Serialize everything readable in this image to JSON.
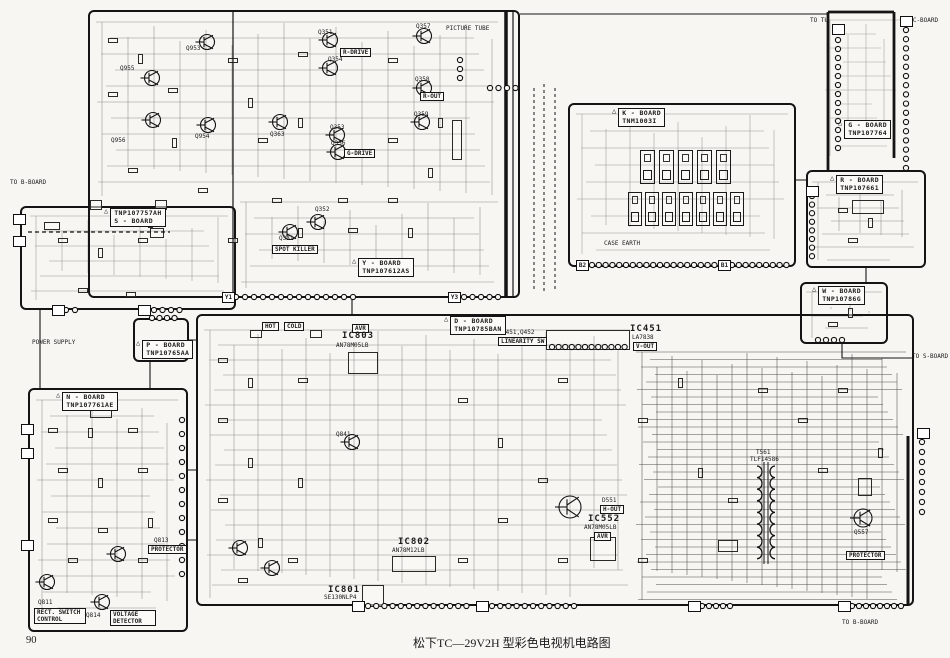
{
  "meta": {
    "caption": "松下TC—29V2H 型彩色电视机电路图",
    "page_number": "90",
    "ink_color": "#141414",
    "paper_color": "#f7f6f2"
  },
  "boards": [
    {
      "name": "Y - BOARD",
      "part": "TNP107612AS",
      "x": 88,
      "y": 10,
      "w": 432,
      "h": 288,
      "lx": 352,
      "ly": 258
    },
    {
      "name": "S - BOARD",
      "part": "TNP107757AH",
      "partFirst": true,
      "x": 20,
      "y": 206,
      "w": 216,
      "h": 104,
      "lx": 104,
      "ly": 208
    },
    {
      "name": "K - BOARD",
      "part": "TNM1003I",
      "x": 568,
      "y": 103,
      "w": 228,
      "h": 164,
      "lx": 612,
      "ly": 108
    },
    {
      "name": "D - BOARD",
      "part": "TNP10785BAN",
      "x": 196,
      "y": 314,
      "w": 718,
      "h": 292,
      "lx": 444,
      "ly": 316
    },
    {
      "name": "N - BOARD",
      "part": "TNP107761AE",
      "x": 28,
      "y": 388,
      "w": 160,
      "h": 244,
      "lx": 56,
      "ly": 392
    },
    {
      "name": "R - BOARD",
      "part": "TNP107661",
      "x": 806,
      "y": 170,
      "w": 120,
      "h": 98,
      "lx": 830,
      "ly": 175
    },
    {
      "name": "W - BOARD",
      "part": "TNP10786G",
      "x": 800,
      "y": 282,
      "w": 88,
      "h": 62,
      "lx": 812,
      "ly": 286
    },
    {
      "name": "P - BOARD",
      "part": "TNP10765AA",
      "x": 133,
      "y": 318,
      "w": 56,
      "h": 44,
      "lx": 136,
      "ly": 340
    },
    {
      "name": "G - BOARD",
      "part": "TNP107764",
      "noborder": true,
      "x": 820,
      "y": 12,
      "w": 126,
      "h": 148,
      "lx": 838,
      "ly": 120
    }
  ],
  "annotations": [
    {
      "t": "Q953",
      "x": 186,
      "y": 46,
      "c": "t"
    },
    {
      "t": "Q955",
      "x": 120,
      "y": 66,
      "c": "t"
    },
    {
      "t": "Q956",
      "x": 111,
      "y": 138,
      "c": "t"
    },
    {
      "t": "Q954",
      "x": 195,
      "y": 134,
      "c": "t"
    },
    {
      "t": "Q363",
      "x": 270,
      "y": 132,
      "c": "t"
    },
    {
      "t": "Q351",
      "x": 318,
      "y": 30,
      "c": "t"
    },
    {
      "t": "Q354",
      "x": 328,
      "y": 57,
      "c": "t"
    },
    {
      "t": "R-DRIVE",
      "x": 340,
      "y": 48,
      "c": "box"
    },
    {
      "t": "Q357",
      "x": 416,
      "y": 24,
      "c": "t"
    },
    {
      "t": "Q358",
      "x": 415,
      "y": 77,
      "c": "t"
    },
    {
      "t": "R-OUT",
      "x": 420,
      "y": 92,
      "c": "box"
    },
    {
      "t": "Q359",
      "x": 414,
      "y": 112,
      "c": "t"
    },
    {
      "t": "Q353",
      "x": 330,
      "y": 125,
      "c": "t"
    },
    {
      "t": "Q356",
      "x": 331,
      "y": 141,
      "c": "t"
    },
    {
      "t": "G-DRIVE",
      "x": 344,
      "y": 149,
      "c": "box"
    },
    {
      "t": "Q352",
      "x": 315,
      "y": 207,
      "c": "t"
    },
    {
      "t": "Q331",
      "x": 279,
      "y": 236,
      "c": "t"
    },
    {
      "t": "SPOT KILLER",
      "x": 272,
      "y": 245,
      "c": "box"
    },
    {
      "t": "PICTURE TUBE",
      "x": 446,
      "y": 26,
      "c": "t"
    },
    {
      "t": "TO B-BOARD",
      "x": 10,
      "y": 180,
      "c": "t"
    },
    {
      "t": "POWER SUPPLY",
      "x": 32,
      "y": 340,
      "c": "t"
    },
    {
      "t": "HOT",
      "x": 262,
      "y": 322,
      "c": "box"
    },
    {
      "t": "COLD",
      "x": 284,
      "y": 322,
      "c": "box"
    },
    {
      "t": "AVR",
      "x": 352,
      "y": 324,
      "c": "box"
    },
    {
      "t": "IC803",
      "x": 342,
      "y": 332,
      "c": "m"
    },
    {
      "t": "AN78M05LB",
      "x": 336,
      "y": 343,
      "c": "t"
    },
    {
      "t": "Q451,Q452",
      "x": 502,
      "y": 330,
      "c": "t"
    },
    {
      "t": "LINEARITY SW",
      "x": 498,
      "y": 337,
      "c": "box"
    },
    {
      "t": "IC451",
      "x": 630,
      "y": 325,
      "c": "m"
    },
    {
      "t": "LA7838",
      "x": 632,
      "y": 335,
      "c": "t"
    },
    {
      "t": "V-OUT",
      "x": 633,
      "y": 342,
      "c": "box"
    },
    {
      "t": "Q841",
      "x": 336,
      "y": 432,
      "c": "t"
    },
    {
      "t": "IC802",
      "x": 398,
      "y": 538,
      "c": "m"
    },
    {
      "t": "AN78M12LB",
      "x": 392,
      "y": 548,
      "c": "t"
    },
    {
      "t": "IC801",
      "x": 328,
      "y": 586,
      "c": "m"
    },
    {
      "t": "SE130NLP4",
      "x": 324,
      "y": 595,
      "c": "t"
    },
    {
      "t": "D551",
      "x": 602,
      "y": 498,
      "c": "t"
    },
    {
      "t": "H-OUT",
      "x": 600,
      "y": 505,
      "c": "box"
    },
    {
      "t": "IC552",
      "x": 588,
      "y": 515,
      "c": "m"
    },
    {
      "t": "AN78M05LB",
      "x": 584,
      "y": 525,
      "c": "t"
    },
    {
      "t": "AVR",
      "x": 594,
      "y": 532,
      "c": "box"
    },
    {
      "t": "T561",
      "x": 756,
      "y": 450,
      "c": "t"
    },
    {
      "t": "TLF14586",
      "x": 750,
      "y": 457,
      "c": "t"
    },
    {
      "t": "Q557",
      "x": 854,
      "y": 530,
      "c": "t"
    },
    {
      "t": "PROTECTOR",
      "x": 846,
      "y": 551,
      "c": "box"
    },
    {
      "t": "CASE EARTH",
      "x": 604,
      "y": 241,
      "c": "t"
    },
    {
      "t": "Q811",
      "x": 38,
      "y": 600,
      "c": "t"
    },
    {
      "t": "RECT. SWITCH CONTROL",
      "x": 34,
      "y": 608,
      "c": "box",
      "w": 46
    },
    {
      "t": "Q814",
      "x": 86,
      "y": 613,
      "c": "t"
    },
    {
      "t": "VOLTAGE DETECTOR",
      "x": 110,
      "y": 610,
      "c": "box",
      "w": 40
    },
    {
      "t": "Q813",
      "x": 154,
      "y": 538,
      "c": "t"
    },
    {
      "t": "PROTECTOR",
      "x": 148,
      "y": 545,
      "c": "box"
    },
    {
      "t": "TO TU",
      "x": 810,
      "y": 18,
      "c": "t"
    },
    {
      "t": "TO C-BOARD",
      "x": 902,
      "y": 18,
      "c": "t"
    },
    {
      "t": "TO S-BOARD",
      "x": 912,
      "y": 354,
      "c": "t"
    },
    {
      "t": "TO B-BOARD",
      "x": 842,
      "y": 620,
      "c": "t"
    }
  ],
  "transistors": [
    {
      "x": 207,
      "y": 42
    },
    {
      "x": 152,
      "y": 78
    },
    {
      "x": 153,
      "y": 120
    },
    {
      "x": 208,
      "y": 125
    },
    {
      "x": 280,
      "y": 122
    },
    {
      "x": 330,
      "y": 40
    },
    {
      "x": 330,
      "y": 68
    },
    {
      "x": 424,
      "y": 36
    },
    {
      "x": 424,
      "y": 88
    },
    {
      "x": 422,
      "y": 122
    },
    {
      "x": 337,
      "y": 135
    },
    {
      "x": 338,
      "y": 152
    },
    {
      "x": 318,
      "y": 222
    },
    {
      "x": 290,
      "y": 232
    },
    {
      "x": 352,
      "y": 442
    },
    {
      "x": 570,
      "y": 507,
      "r": 11
    },
    {
      "x": 863,
      "y": 518,
      "r": 9
    },
    {
      "x": 47,
      "y": 582
    },
    {
      "x": 102,
      "y": 602
    },
    {
      "x": 118,
      "y": 554
    },
    {
      "x": 240,
      "y": 548
    },
    {
      "x": 272,
      "y": 568
    }
  ],
  "parts": [
    {
      "x": 348,
      "y": 352,
      "w": 30,
      "h": 22
    },
    {
      "x": 546,
      "y": 330,
      "w": 84,
      "h": 20
    },
    {
      "x": 590,
      "y": 537,
      "w": 26,
      "h": 24
    },
    {
      "x": 392,
      "y": 556,
      "w": 44,
      "h": 16
    },
    {
      "x": 362,
      "y": 585,
      "w": 22,
      "h": 22
    },
    {
      "x": 108,
      "y": 38,
      "w": 10,
      "h": 5
    },
    {
      "x": 108,
      "y": 92,
      "w": 10,
      "h": 5
    },
    {
      "x": 138,
      "y": 54,
      "w": 5,
      "h": 10
    },
    {
      "x": 168,
      "y": 88,
      "w": 10,
      "h": 5
    },
    {
      "x": 172,
      "y": 138,
      "w": 5,
      "h": 10
    },
    {
      "x": 228,
      "y": 58,
      "w": 10,
      "h": 5
    },
    {
      "x": 248,
      "y": 98,
      "w": 5,
      "h": 10
    },
    {
      "x": 258,
      "y": 138,
      "w": 10,
      "h": 5
    },
    {
      "x": 298,
      "y": 52,
      "w": 10,
      "h": 5
    },
    {
      "x": 298,
      "y": 118,
      "w": 5,
      "h": 10
    },
    {
      "x": 388,
      "y": 58,
      "w": 10,
      "h": 5
    },
    {
      "x": 388,
      "y": 138,
      "w": 10,
      "h": 5
    },
    {
      "x": 438,
      "y": 118,
      "w": 5,
      "h": 10
    },
    {
      "x": 272,
      "y": 198,
      "w": 10,
      "h": 5
    },
    {
      "x": 298,
      "y": 228,
      "w": 5,
      "h": 10
    },
    {
      "x": 338,
      "y": 198,
      "w": 10,
      "h": 5
    },
    {
      "x": 388,
      "y": 198,
      "w": 10,
      "h": 5
    },
    {
      "x": 428,
      "y": 168,
      "w": 5,
      "h": 10
    },
    {
      "x": 128,
      "y": 168,
      "w": 10,
      "h": 5
    },
    {
      "x": 148,
      "y": 218,
      "w": 5,
      "h": 10
    },
    {
      "x": 198,
      "y": 188,
      "w": 10,
      "h": 5
    },
    {
      "x": 228,
      "y": 238,
      "w": 10,
      "h": 5
    },
    {
      "x": 348,
      "y": 228,
      "w": 10,
      "h": 5
    },
    {
      "x": 408,
      "y": 228,
      "w": 5,
      "h": 10
    },
    {
      "x": 452,
      "y": 120,
      "w": 10,
      "h": 40
    },
    {
      "x": 90,
      "y": 200,
      "w": 12,
      "h": 10
    },
    {
      "x": 155,
      "y": 200,
      "w": 12,
      "h": 10
    },
    {
      "x": 58,
      "y": 238,
      "w": 10,
      "h": 5
    },
    {
      "x": 98,
      "y": 248,
      "w": 5,
      "h": 10
    },
    {
      "x": 138,
      "y": 238,
      "w": 10,
      "h": 5
    },
    {
      "x": 78,
      "y": 288,
      "w": 10,
      "h": 5
    },
    {
      "x": 126,
      "y": 292,
      "w": 10,
      "h": 5
    },
    {
      "x": 44,
      "y": 222,
      "w": 16,
      "h": 8
    },
    {
      "x": 150,
      "y": 228,
      "w": 14,
      "h": 10
    },
    {
      "x": 48,
      "y": 428,
      "w": 10,
      "h": 5
    },
    {
      "x": 88,
      "y": 428,
      "w": 5,
      "h": 10
    },
    {
      "x": 128,
      "y": 428,
      "w": 10,
      "h": 5
    },
    {
      "x": 58,
      "y": 468,
      "w": 10,
      "h": 5
    },
    {
      "x": 98,
      "y": 478,
      "w": 5,
      "h": 10
    },
    {
      "x": 138,
      "y": 468,
      "w": 10,
      "h": 5
    },
    {
      "x": 48,
      "y": 518,
      "w": 10,
      "h": 5
    },
    {
      "x": 98,
      "y": 528,
      "w": 10,
      "h": 5
    },
    {
      "x": 148,
      "y": 518,
      "w": 5,
      "h": 10
    },
    {
      "x": 68,
      "y": 558,
      "w": 10,
      "h": 5
    },
    {
      "x": 138,
      "y": 558,
      "w": 10,
      "h": 5
    },
    {
      "x": 90,
      "y": 410,
      "w": 22,
      "h": 8
    },
    {
      "x": 218,
      "y": 358,
      "w": 10,
      "h": 5
    },
    {
      "x": 248,
      "y": 378,
      "w": 5,
      "h": 10
    },
    {
      "x": 218,
      "y": 418,
      "w": 10,
      "h": 5
    },
    {
      "x": 248,
      "y": 458,
      "w": 5,
      "h": 10
    },
    {
      "x": 218,
      "y": 498,
      "w": 10,
      "h": 5
    },
    {
      "x": 258,
      "y": 538,
      "w": 5,
      "h": 10
    },
    {
      "x": 298,
      "y": 378,
      "w": 10,
      "h": 5
    },
    {
      "x": 298,
      "y": 478,
      "w": 5,
      "h": 10
    },
    {
      "x": 458,
      "y": 398,
      "w": 10,
      "h": 5
    },
    {
      "x": 498,
      "y": 438,
      "w": 5,
      "h": 10
    },
    {
      "x": 538,
      "y": 478,
      "w": 10,
      "h": 5
    },
    {
      "x": 458,
      "y": 558,
      "w": 10,
      "h": 5
    },
    {
      "x": 558,
      "y": 378,
      "w": 10,
      "h": 5
    },
    {
      "x": 698,
      "y": 468,
      "w": 5,
      "h": 10
    },
    {
      "x": 728,
      "y": 498,
      "w": 10,
      "h": 5
    },
    {
      "x": 818,
      "y": 468,
      "w": 10,
      "h": 5
    },
    {
      "x": 638,
      "y": 418,
      "w": 10,
      "h": 5
    },
    {
      "x": 678,
      "y": 378,
      "w": 5,
      "h": 10
    },
    {
      "x": 758,
      "y": 388,
      "w": 10,
      "h": 5
    },
    {
      "x": 798,
      "y": 418,
      "w": 10,
      "h": 5
    },
    {
      "x": 838,
      "y": 388,
      "w": 10,
      "h": 5
    },
    {
      "x": 878,
      "y": 448,
      "w": 5,
      "h": 10
    },
    {
      "x": 498,
      "y": 518,
      "w": 10,
      "h": 5
    },
    {
      "x": 558,
      "y": 558,
      "w": 10,
      "h": 5
    },
    {
      "x": 638,
      "y": 558,
      "w": 10,
      "h": 5
    },
    {
      "x": 238,
      "y": 578,
      "w": 10,
      "h": 5
    },
    {
      "x": 288,
      "y": 558,
      "w": 10,
      "h": 5
    },
    {
      "x": 858,
      "y": 478,
      "w": 14,
      "h": 18
    },
    {
      "x": 718,
      "y": 540,
      "w": 20,
      "h": 12
    },
    {
      "x": 250,
      "y": 330,
      "w": 12,
      "h": 8
    },
    {
      "x": 310,
      "y": 330,
      "w": 12,
      "h": 8
    },
    {
      "x": 838,
      "y": 208,
      "w": 10,
      "h": 5
    },
    {
      "x": 868,
      "y": 218,
      "w": 5,
      "h": 10
    },
    {
      "x": 848,
      "y": 238,
      "w": 10,
      "h": 5
    },
    {
      "x": 852,
      "y": 200,
      "w": 32,
      "h": 14
    },
    {
      "x": 818,
      "y": 298,
      "w": 10,
      "h": 5
    },
    {
      "x": 848,
      "y": 308,
      "w": 5,
      "h": 10
    },
    {
      "x": 828,
      "y": 322,
      "w": 10,
      "h": 5
    }
  ],
  "modules": [
    {
      "x": 640,
      "y": 150,
      "w": 15,
      "h": 34
    },
    {
      "x": 659,
      "y": 150,
      "w": 15,
      "h": 34
    },
    {
      "x": 678,
      "y": 150,
      "w": 15,
      "h": 34
    },
    {
      "x": 697,
      "y": 150,
      "w": 15,
      "h": 34
    },
    {
      "x": 716,
      "y": 150,
      "w": 15,
      "h": 34
    },
    {
      "x": 628,
      "y": 192,
      "w": 14,
      "h": 34
    },
    {
      "x": 645,
      "y": 192,
      "w": 14,
      "h": 34
    },
    {
      "x": 662,
      "y": 192,
      "w": 14,
      "h": 34
    },
    {
      "x": 679,
      "y": 192,
      "w": 14,
      "h": 34
    },
    {
      "x": 696,
      "y": 192,
      "w": 14,
      "h": 34
    },
    {
      "x": 713,
      "y": 192,
      "w": 14,
      "h": 34
    },
    {
      "x": 730,
      "y": 192,
      "w": 14,
      "h": 34
    }
  ],
  "connectors": [
    {
      "x": 236,
      "y": 297,
      "dx": 9,
      "dy": 0,
      "n": 14
    },
    {
      "x": 464,
      "y": 297,
      "dx": 8.5,
      "dy": 0,
      "n": 5
    },
    {
      "x": 66,
      "y": 310,
      "dx": 9,
      "dy": 0,
      "n": 2
    },
    {
      "x": 154,
      "y": 310,
      "dx": 8.5,
      "dy": 0,
      "n": 4
    },
    {
      "x": 152,
      "y": 318,
      "dx": 7.5,
      "dy": 0,
      "n": 4
    },
    {
      "x": 592,
      "y": 265,
      "dx": 6.8,
      "dy": 0,
      "n": 19
    },
    {
      "x": 732,
      "y": 265,
      "dx": 6.8,
      "dy": 0,
      "n": 9
    },
    {
      "x": 368,
      "y": 606,
      "dx": 8.2,
      "dy": 0,
      "n": 13
    },
    {
      "x": 492,
      "y": 606,
      "dx": 8.2,
      "dy": 0,
      "n": 11
    },
    {
      "x": 702,
      "y": 606,
      "dx": 7,
      "dy": 0,
      "n": 5
    },
    {
      "x": 852,
      "y": 606,
      "dx": 7,
      "dy": 0,
      "n": 8
    },
    {
      "x": 182,
      "y": 420,
      "dx": 0,
      "dy": 14,
      "n": 12
    },
    {
      "x": 838,
      "y": 40,
      "dx": 0,
      "dy": 9,
      "n": 13
    },
    {
      "x": 906,
      "y": 30,
      "dx": 0,
      "dy": 9.2,
      "n": 16
    },
    {
      "x": 812,
      "y": 196,
      "dx": 0,
      "dy": 8.6,
      "n": 8
    },
    {
      "x": 818,
      "y": 340,
      "dx": 8,
      "dy": 0,
      "n": 4
    },
    {
      "x": 922,
      "y": 442,
      "dx": 0,
      "dy": 10,
      "n": 8
    },
    {
      "x": 552,
      "y": 347,
      "dx": 6.6,
      "dy": 0,
      "n": 12
    },
    {
      "x": 490,
      "y": 88,
      "dx": 8.5,
      "dy": 0,
      "n": 4
    },
    {
      "x": 460,
      "y": 60,
      "dx": 0,
      "dy": 9,
      "n": 3
    }
  ],
  "conn_boxes": [
    {
      "x": 576,
      "y": 260,
      "l": "B2"
    },
    {
      "x": 718,
      "y": 260,
      "l": "B1"
    },
    {
      "x": 448,
      "y": 292,
      "l": "Y3"
    },
    {
      "x": 222,
      "y": 292,
      "l": "Y1"
    },
    {
      "x": 52,
      "y": 305,
      "l": ""
    },
    {
      "x": 138,
      "y": 305,
      "l": ""
    },
    {
      "x": 352,
      "y": 601,
      "l": ""
    },
    {
      "x": 476,
      "y": 601,
      "l": ""
    },
    {
      "x": 838,
      "y": 601,
      "l": ""
    },
    {
      "x": 688,
      "y": 601,
      "l": ""
    },
    {
      "x": 917,
      "y": 428,
      "l": ""
    },
    {
      "x": 832,
      "y": 24,
      "l": ""
    },
    {
      "x": 900,
      "y": 16,
      "l": ""
    },
    {
      "x": 13,
      "y": 214,
      "l": ""
    },
    {
      "x": 13,
      "y": 236,
      "l": ""
    },
    {
      "x": 21,
      "y": 424,
      "l": ""
    },
    {
      "x": 21,
      "y": 448,
      "l": ""
    },
    {
      "x": 21,
      "y": 540,
      "l": ""
    },
    {
      "x": 806,
      "y": 186,
      "l": ""
    }
  ]
}
